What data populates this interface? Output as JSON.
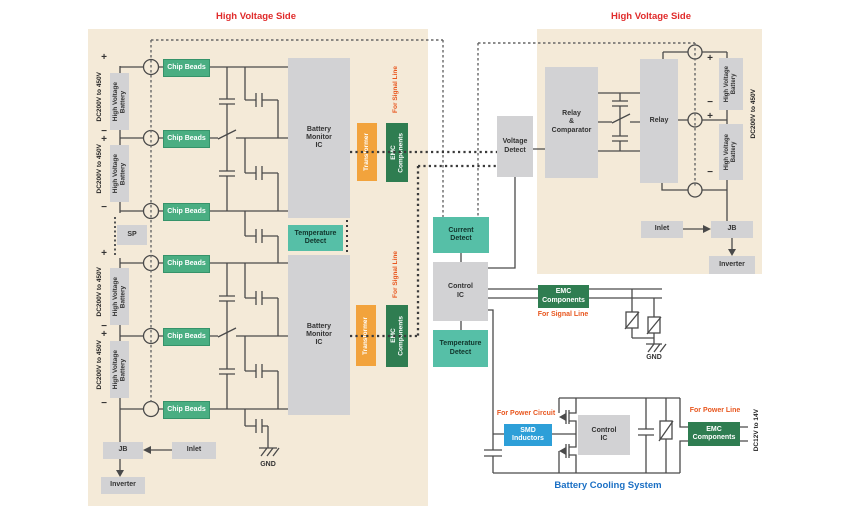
{
  "left_panel": {
    "title": "High Voltage Side",
    "dc_range": "DC200V to 450V",
    "battery_label": "High Voltage\nBattery",
    "plus": "+",
    "minus": "−",
    "chip_beads": "Chip Beads",
    "sp": "SP",
    "monitor_ic": "Battery\nMonitor\nIC",
    "temperature_detect": "Temperature\nDetect",
    "jb": "JB",
    "inlet": "Inlet",
    "inverter": "Inverter",
    "gnd": "GND"
  },
  "isolation": {
    "transformer": "Transformer",
    "emc_components": "EMC\nComponents",
    "for_signal_line": "For Signal Line"
  },
  "center": {
    "voltage_detect": "Voltage\nDetect",
    "current_detect": "Current\nDetect",
    "control_ic": "Control\nIC",
    "temperature_detect": "Temperature\nDetect",
    "emc_components": "EMC\nComponents",
    "for_signal_line": "For Signal Line",
    "gnd": "GND"
  },
  "right_panel": {
    "title": "High Voltage Side",
    "relay_comparator": "Relay\n&\nComparator",
    "relay": "Relay",
    "battery_label": "High Voltage\nBattery",
    "dc_range": "DC200V to 450V",
    "plus": "+",
    "minus": "−",
    "inlet": "Inlet",
    "jb": "JB",
    "inverter": "Inverter"
  },
  "cooling": {
    "for_power_circuit": "For Power Circuit",
    "smd_inductors": "SMD\nInductors",
    "control_ic": "Control\nIC",
    "for_power_line": "For Power Line",
    "emc_components": "EMC\nComponents",
    "dc_range": "DC12V to 14V",
    "caption": "Battery Cooling System"
  },
  "colors": {
    "panel_bg": "#f4ead8",
    "chip_beads_green": "#4aae82",
    "detect_teal": "#56bfa7",
    "emc_dark_green": "#2f7d51",
    "transformer_orange": "#f2a33c",
    "smd_blue": "#2d9fd8",
    "title_red": "#e02b2b",
    "annotation_orange": "#e8571f",
    "caption_blue": "#1a6fc4",
    "wire": "#4a4a4a"
  }
}
